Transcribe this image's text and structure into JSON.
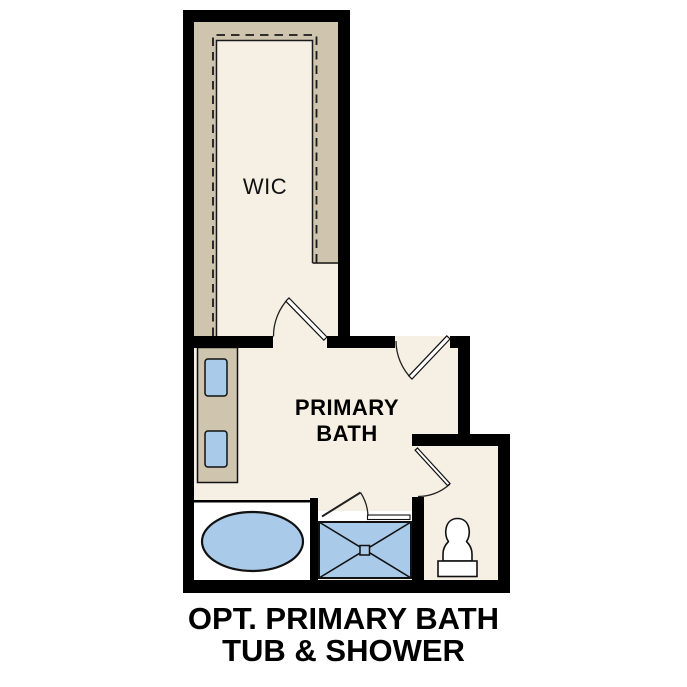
{
  "diagram": {
    "type": "floor-plan",
    "caption": {
      "line1": "OPT. PRIMARY BATH",
      "line2": "TUB & SHOWER"
    },
    "rooms": {
      "wic": {
        "label": "WIC"
      },
      "bath": {
        "label_line1": "PRIMARY",
        "label_line2": "BATH"
      },
      "water_closet": {
        "label": ""
      }
    },
    "fixtures": [
      "closet-shelving",
      "dual-sink-vanity",
      "soaking-tub",
      "walk-in-shower-with-glass-door",
      "toilet"
    ],
    "doors": [
      "wic-swing-door",
      "bath-entry-swing-door",
      "water-closet-swing-door",
      "shower-glass-door"
    ]
  },
  "colors": {
    "wall": "#000000",
    "floor": "#F6F0E4",
    "casework": "#CFC4AE",
    "fixture_blue": "#A9CAE9",
    "fixture_white": "#FFFFFF",
    "background": "#FFFFFF"
  }
}
